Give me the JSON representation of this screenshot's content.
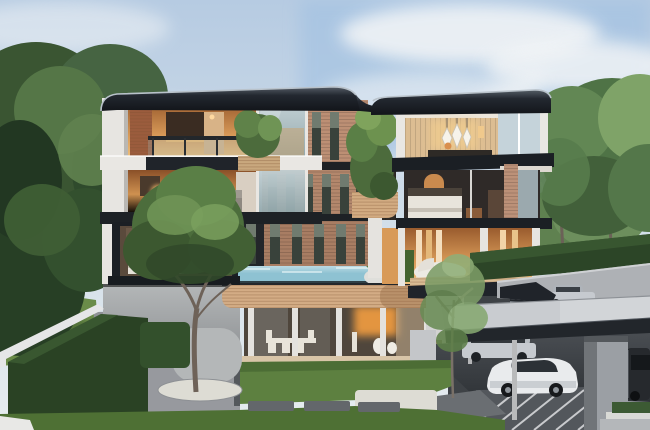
{
  "scene": {
    "type": "photorealistic architectural exterior rendering",
    "subject": "modern four-storey luxury house with cantilevered floors, brick screen facade, rooftop planters, an elevated lap pool and an attached flat-roof carport",
    "setting": "landscaped hillside lot with lawns, mature trees, clipped hedges and a side street climbing to the right",
    "time_of_day": "daytime",
    "weather": "partly cloudy, soft sunlight"
  },
  "objects": {
    "building": {
      "storeys": 4,
      "features": [
        "dark flat roofs with rounded corners",
        "white piers and slim columns",
        "warmly lit interiors (kitchen, living room, bedrooms, dining terrace)",
        "tall narrow windows in brick facade",
        "balcony planters with shrubs",
        "glass-walled ground floor",
        "wood-slat spandrel band",
        "elevated blue lap pool",
        "gray podium wall with white retaining wall"
      ]
    },
    "vehicles": [
      {
        "name": "white sports car",
        "location": "under carport, front"
      },
      {
        "name": "silver suv",
        "location": "under carport, rear"
      },
      {
        "name": "dark minivan",
        "location": "right edge, beside carport pillar"
      },
      {
        "name": "silver sedan",
        "location": "parked on the side street"
      }
    ],
    "vegetation": [
      "large dark trees on the left",
      "tall trees on the right behind the street hedge",
      "clipped roadside hedge",
      "front courtyard tree in white gravel bed",
      "slender tree beside the carport",
      "rooftop and balcony shrubs",
      "front lawn with stepping stones"
    ],
    "pool": {
      "color": "light blue",
      "position": "second level deck, center"
    },
    "birds": {
      "count": 5,
      "position": "upper left sky"
    }
  },
  "palette": {
    "sky_top": "#b6cbe2",
    "sky_low": "#e4ebf0",
    "cloud": "#f4f6f7",
    "mountain": "#9db1bd",
    "foliage_dark": "#2f4a2c",
    "foliage_mid": "#4f7346",
    "foliage_light": "#7fa368",
    "hedge": "#2c4527",
    "lawn": "#5d8040",
    "lawn_dark": "#41602e",
    "brick": "#bc8f74",
    "wood_slat": "#d3ac85",
    "wood_wall": "#dcbd92",
    "roof_dark": "#1a1e24",
    "slab_dark": "#1d2125",
    "white_trim": "#e9e7e3",
    "glass_reflection": "#aebfc0",
    "pool": "#8ec2d2",
    "warm_light": "#e2a156",
    "warm_deep": "#8a5028",
    "podium": "#a3a6a8",
    "driveway": "#8f9296",
    "street": "#aeb1b5",
    "carport_roof": "#c9ccd0",
    "asphalt": "#53575c",
    "stripe_white": "#d6d8da",
    "car_white": "#e9ebed",
    "car_silver": "#c6cacf",
    "gravel_white": "#dddcd4"
  }
}
